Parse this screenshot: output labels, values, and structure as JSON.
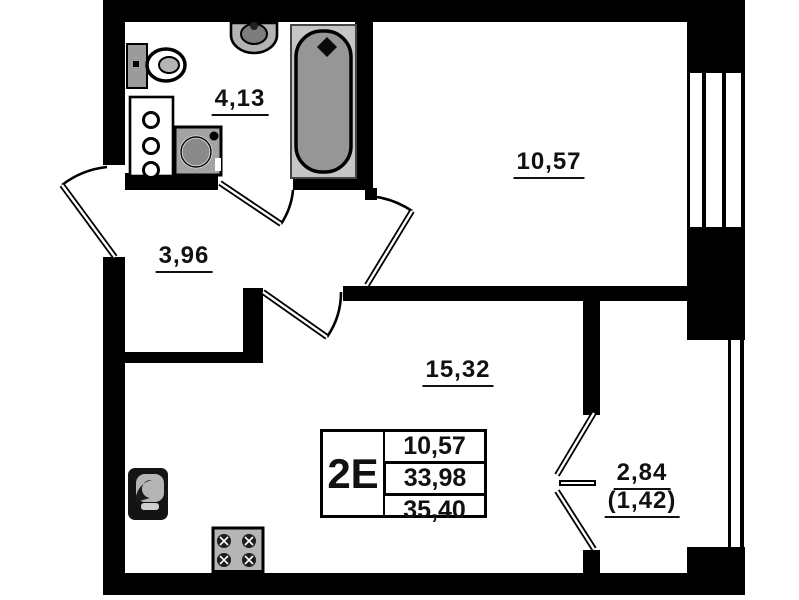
{
  "unit": {
    "type_label": "2Е",
    "stamp_values": [
      "10,57",
      "33,98",
      "35,40"
    ]
  },
  "rooms": {
    "bathroom": {
      "area": "4,13"
    },
    "bedroom": {
      "area": "10,57"
    },
    "hallway": {
      "area": "3,96"
    },
    "kitchen_living": {
      "area": "15,32"
    },
    "balcony": {
      "area": "2,84",
      "area_with_coefficient": "(1,42)"
    }
  },
  "icons": {
    "toilet": "toilet-icon",
    "wall_sink": "sink-icon",
    "cabinet": "cabinet-icon",
    "washing_machine": "washing-machine-icon",
    "bathtub": "bathtub-icon",
    "kitchen_sink": "kitchen-sink-icon",
    "stove": "stove-icon"
  },
  "colors": {
    "walls": "#000000",
    "background": "#ffffff",
    "fixture_gray": "#9a9a9a",
    "tub_outer_gray": "#c6c6c6"
  }
}
